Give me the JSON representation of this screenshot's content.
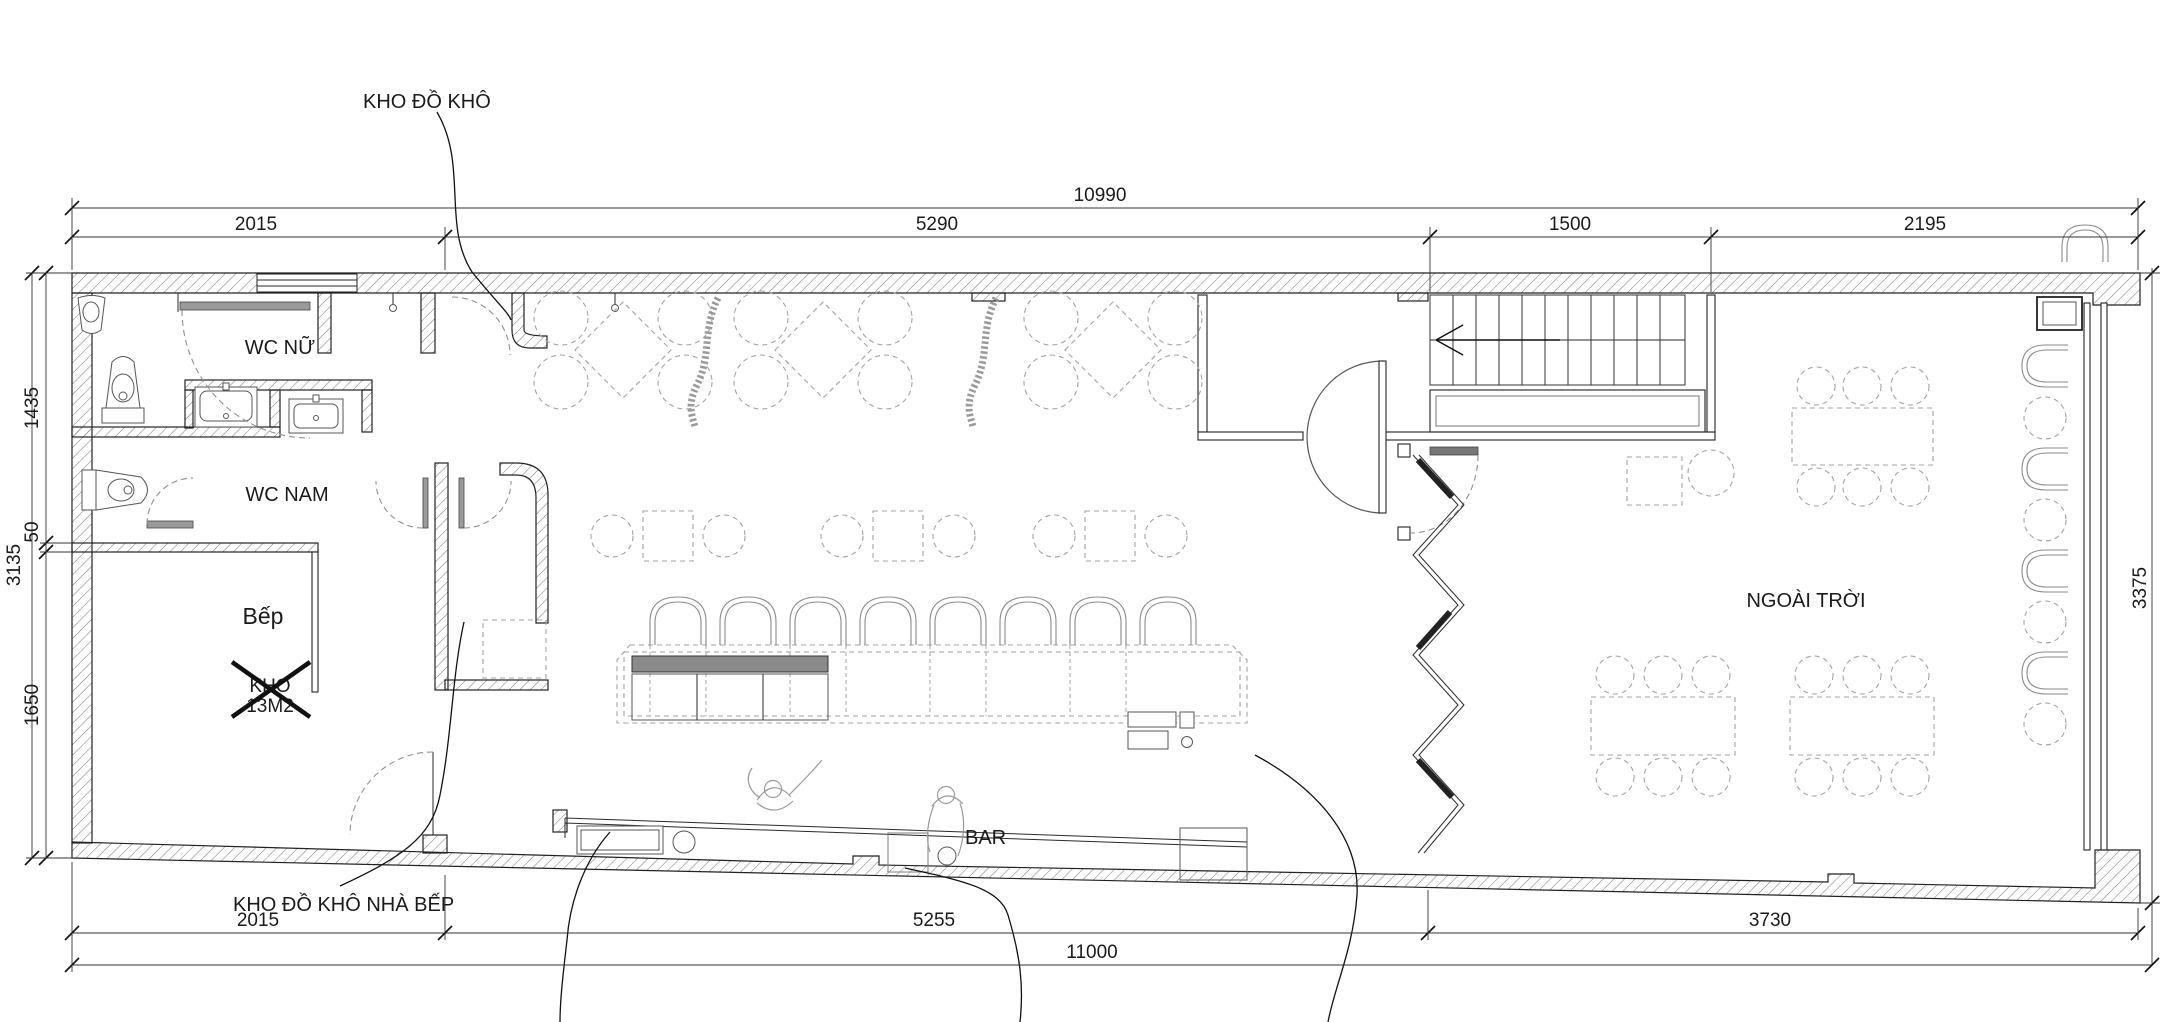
{
  "drawing_type": "restaurant-bar-floor-plan",
  "labels": {
    "dry_storage": "KHO ĐỒ KHÔ",
    "kitchen_dry_storage": "KHO ĐỒ KHÔ NHÀ BẾP",
    "wc_women": "WC NỮ",
    "wc_men": "WC NAM",
    "kitchen": "Bếp",
    "storage_crossed_line1": "KHO",
    "storage_crossed_line2": "13M2",
    "bar": "BAR",
    "outdoor": "NGOÀI TRỜI"
  },
  "dimensions": {
    "top_total": "10990",
    "top_segments": [
      "2015",
      "5290",
      "1500",
      "2195"
    ],
    "left_total": "3135",
    "left_segments": [
      "1435",
      "50",
      "1650"
    ],
    "right_total": "3375",
    "bottom_segments": [
      "2015",
      "5255",
      "3730"
    ],
    "bottom_total": "11000"
  },
  "colors": {
    "line": "#1f1f1f",
    "hatch": "#6a6a6a",
    "furniture_dashed": "#a3a3a3",
    "door_arc": "#8f8f8f",
    "equipment_dark": "#8a8a8a"
  }
}
